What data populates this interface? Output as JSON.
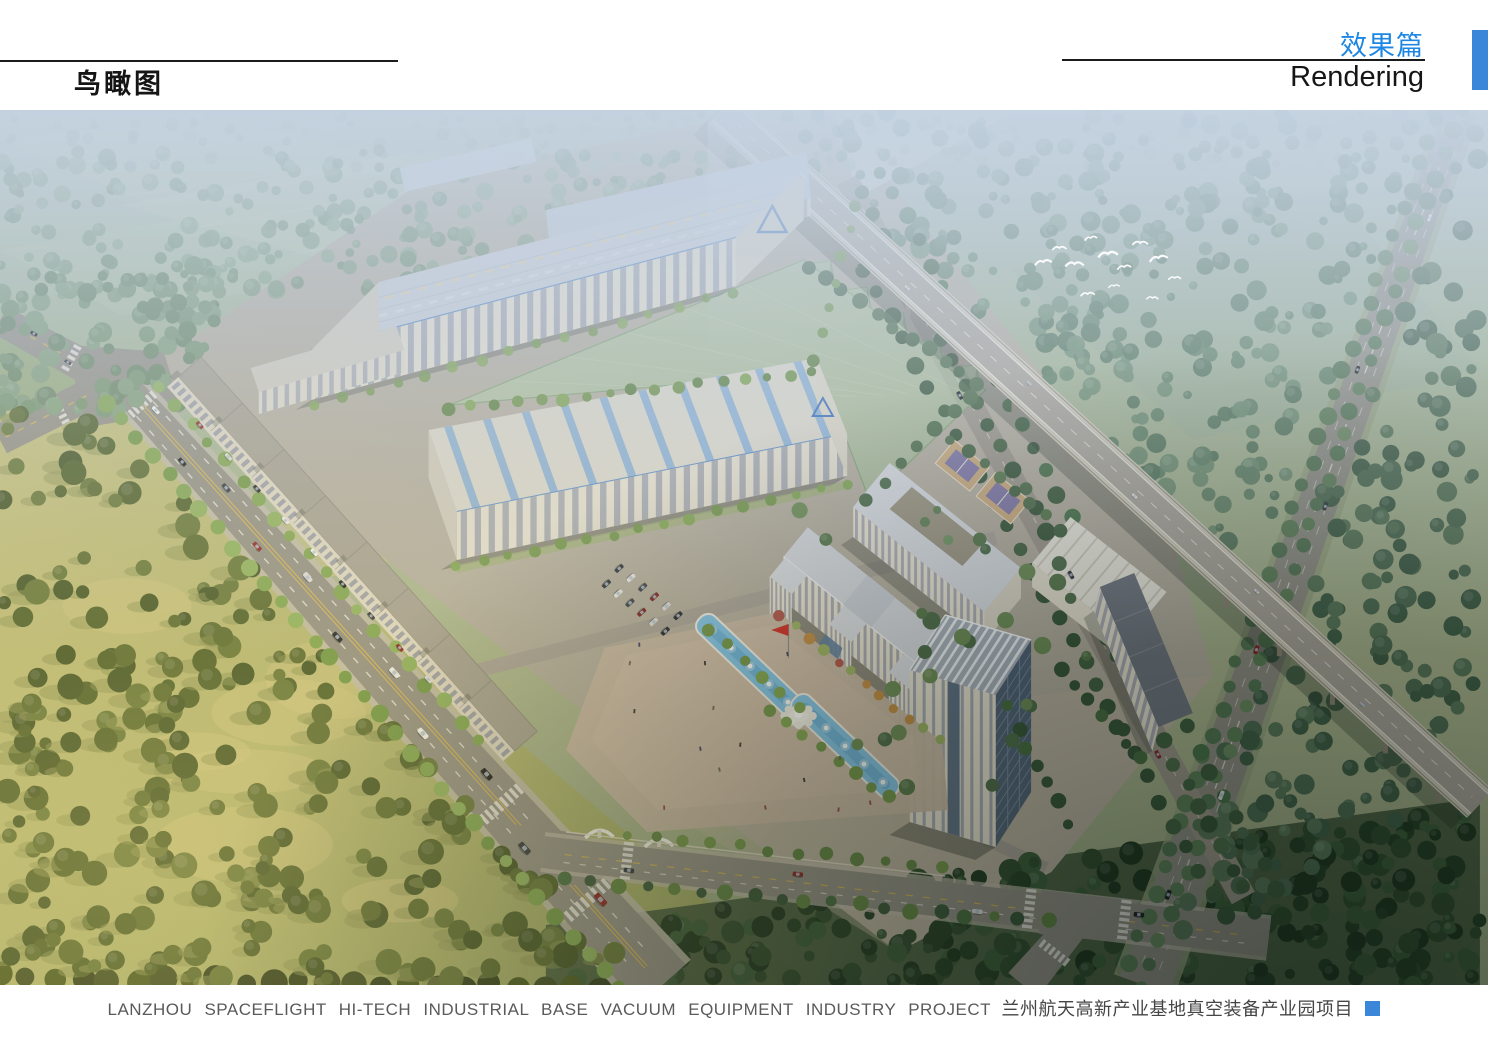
{
  "header": {
    "page_title": "鸟瞰图",
    "section_title_zh": "效果篇",
    "section_title_en": "Rendering"
  },
  "footer": {
    "caption_en": "LANZHOU  SPACEFLIGHT  HI-TECH INDUSTRIAL BASE  VACUUM  EQUIPMENT  INDUSTRY  PROJECT",
    "caption_zh": "兰州航天高新产业基地真空装备产业园项目"
  },
  "colors": {
    "accent_blue": "#1e87e4",
    "accent_square": "#3a87d9",
    "rule_line": "#1b1b1b"
  }
}
